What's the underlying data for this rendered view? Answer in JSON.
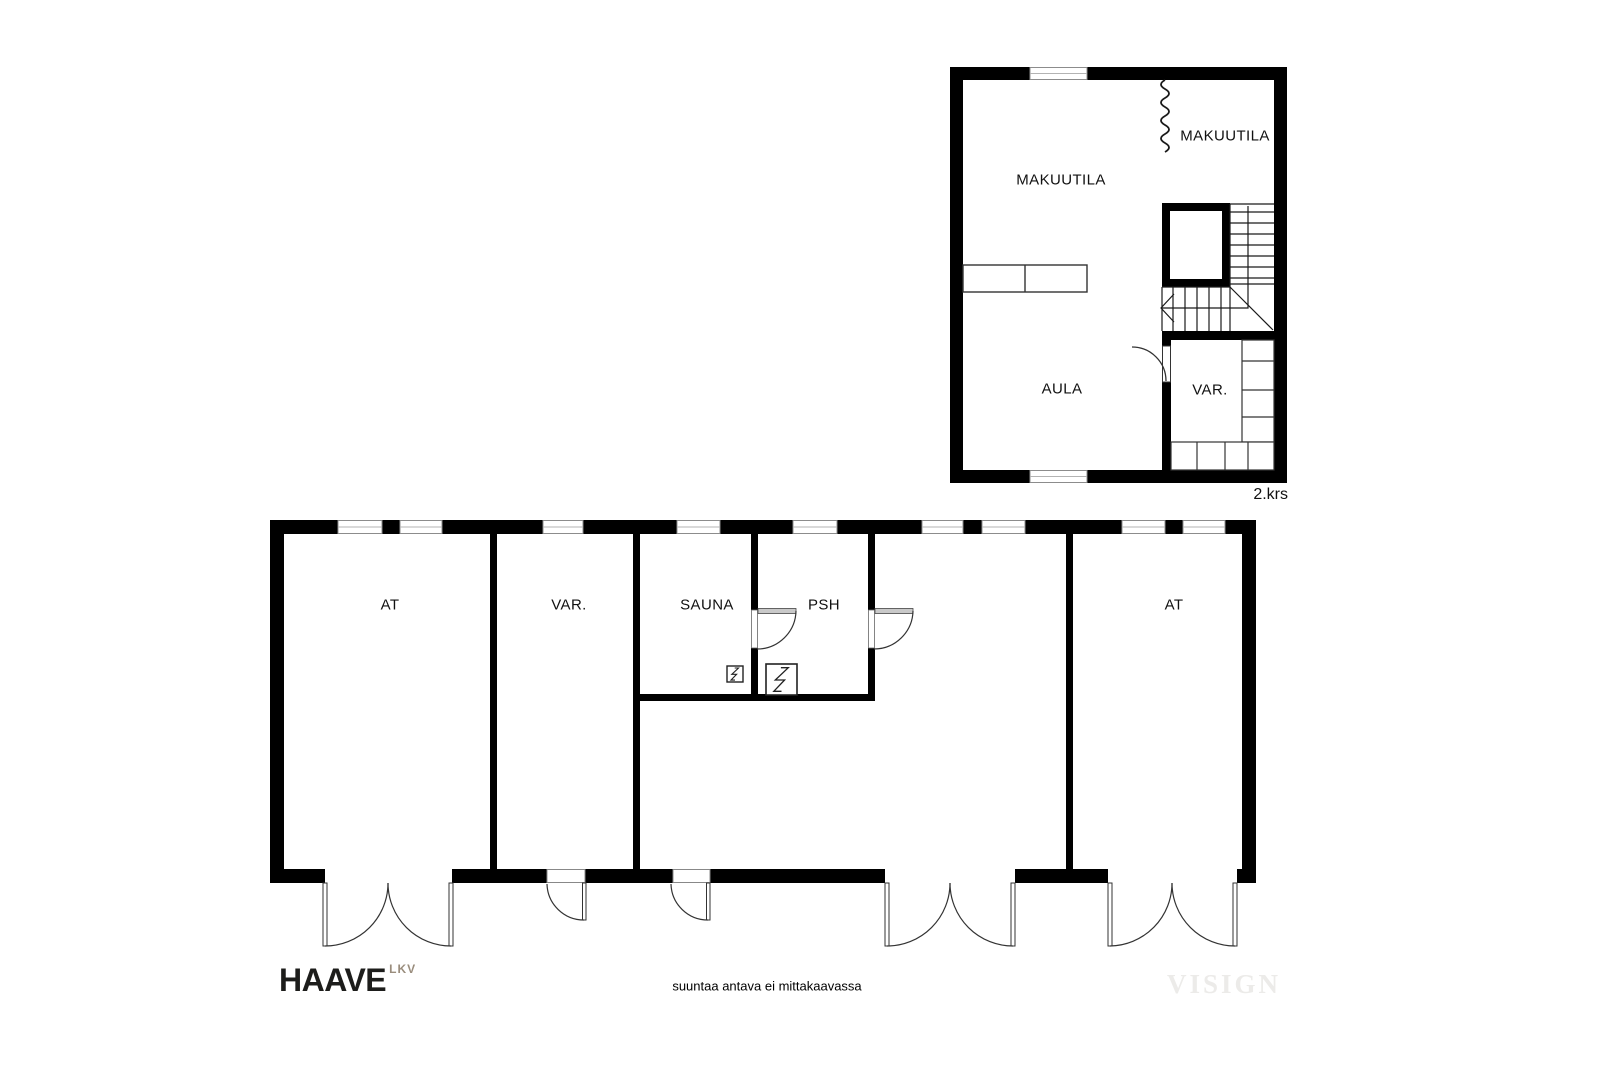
{
  "upper_floor": {
    "floor_label": "2.krs",
    "rooms": {
      "makuutila_left": "MAKUUTILA",
      "makuutila_right": "MAKUUTILA",
      "aula": "AULA",
      "var": "VAR."
    }
  },
  "lower_floor": {
    "rooms": {
      "at_left": "AT",
      "var": "VAR.",
      "sauna": "SAUNA",
      "psh": "PSH",
      "at_right": "AT"
    }
  },
  "footer": {
    "brand_name": "HAAVE",
    "brand_suffix": "LKV",
    "disclaimer": "suuntaa antava ei mittakaavassa",
    "watermark": "VISIGN"
  },
  "icons": {
    "sauna_stove": "lightning-in-square",
    "water_heater": "lightning-in-square",
    "stair_direction": "left-arrow-walk-line",
    "open_partition": "wavy-line"
  },
  "colors": {
    "wall": "#000000",
    "thin_line": "#1a1a1a",
    "window_frame": "#8c8c8c",
    "door_leaf_gray": "#c9c9c9",
    "brand_text": "#1d1d1b",
    "brand_suffix": "#9a8d7d",
    "watermark": "#ecebe9",
    "background": "#ffffff"
  }
}
